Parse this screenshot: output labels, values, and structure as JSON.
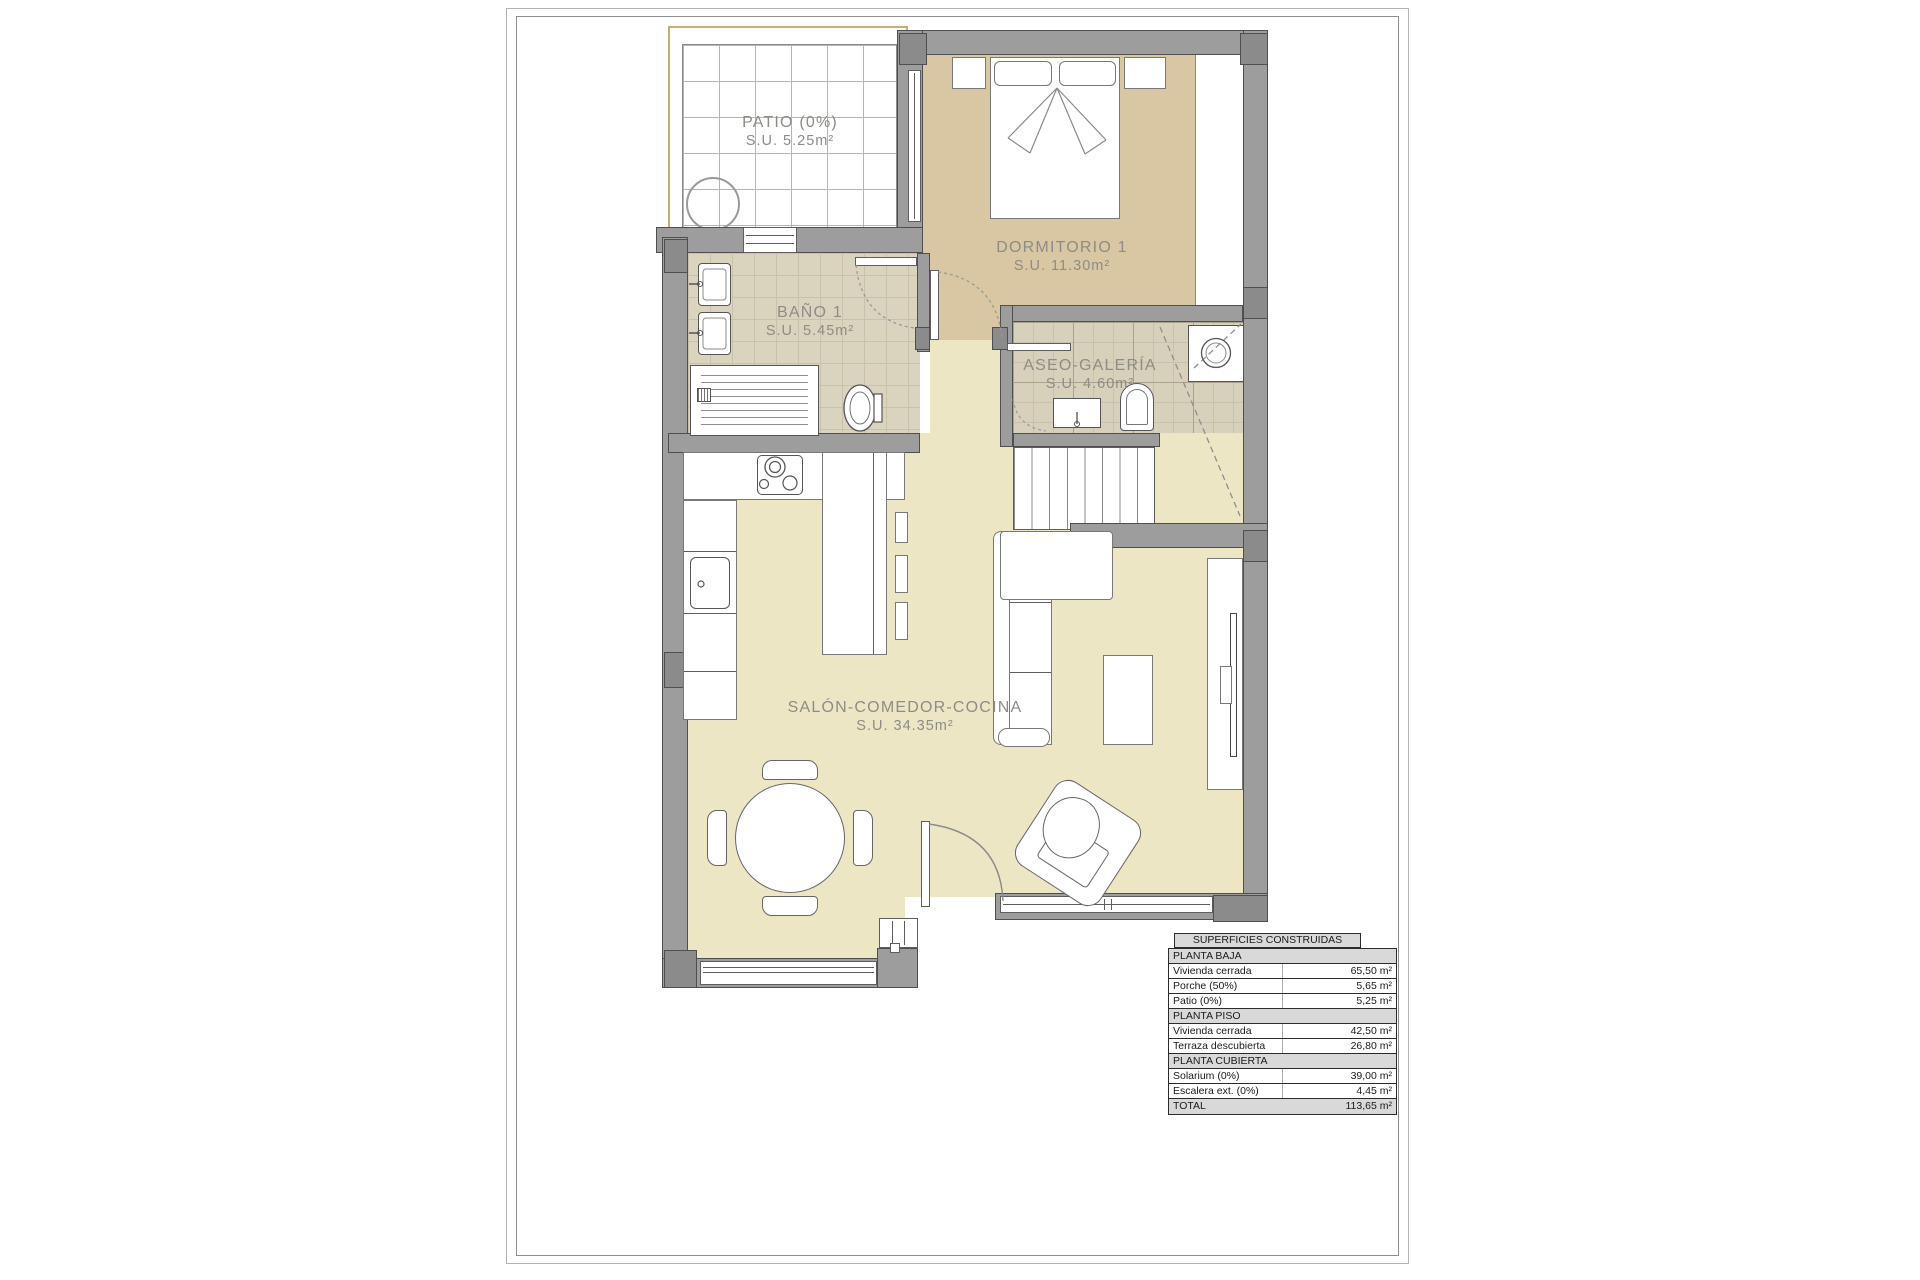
{
  "document_type": "floor-plan",
  "rooms": {
    "patio": {
      "name": "PATIO (0%)",
      "area": "S.U. 5.25m²"
    },
    "dormitorio1": {
      "name": "DORMITORIO 1",
      "area": "S.U. 11.30m²"
    },
    "bano1": {
      "name": "BAÑO 1",
      "area": "S.U. 5.45m²"
    },
    "aseo": {
      "name": "ASEO-GALERÍA",
      "area": "S.U. 4.60m²"
    },
    "salon": {
      "name": "SALÓN-COMEDOR-COCINA",
      "area": "S.U. 34.35m²"
    }
  },
  "areas_table": {
    "title": "SUPERFICIES CONSTRUIDAS TOTALES",
    "rows": [
      {
        "label": "PLANTA BAJA",
        "value": ""
      },
      {
        "label": "Vivienda cerrada",
        "value": "65,50 m²"
      },
      {
        "label": "Porche (50%)",
        "value": "5,65 m²"
      },
      {
        "label": "Patio (0%)",
        "value": "5,25 m²"
      },
      {
        "label": "PLANTA PISO",
        "value": ""
      },
      {
        "label": "Vivienda cerrada",
        "value": "42,50 m²"
      },
      {
        "label": "Terraza descubierta (0%)",
        "value": "26,80 m²"
      },
      {
        "label": "PLANTA CUBIERTA",
        "value": ""
      },
      {
        "label": "Solarium (0%)",
        "value": "39,00 m²"
      },
      {
        "label": "Escalera ext. (0%)",
        "value": "4,45 m²"
      },
      {
        "label": "TOTAL",
        "value": "113,65 m²"
      }
    ]
  },
  "colors": {
    "wall": "#9d9d9d",
    "wall_outline": "#4f4f4f",
    "floor_living": "#ece6c4",
    "floor_bedroom": "#d8c7a2",
    "floor_tile": "#dad3be",
    "patio_boundary": "#c9ab74",
    "table_header_bg": "#d9d9d9",
    "label_text": "#8e8c86"
  }
}
